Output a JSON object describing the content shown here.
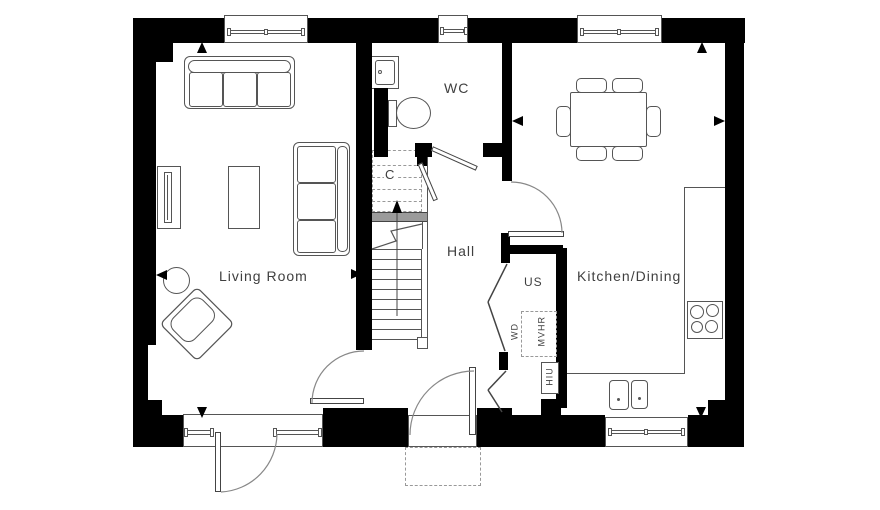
{
  "title": "Ground floor plan",
  "labels": {
    "living_room": "Living Room",
    "hall": "Hall",
    "wc": "WC",
    "kitchen_dining": "Kitchen/Dining",
    "understairs_cupboard": "C",
    "utility_store": "US",
    "washer_dryer": "WD",
    "mvhr": "MVHR",
    "hiu": "HIU"
  },
  "stairs": {
    "direction": "up",
    "flights_shown": 1
  },
  "colors": {
    "wall": "#000000",
    "line": "#555555",
    "light_line": "#999999",
    "text": "#3f3f3f",
    "stair_band": "#9b9b9b",
    "background": "#ffffff"
  }
}
